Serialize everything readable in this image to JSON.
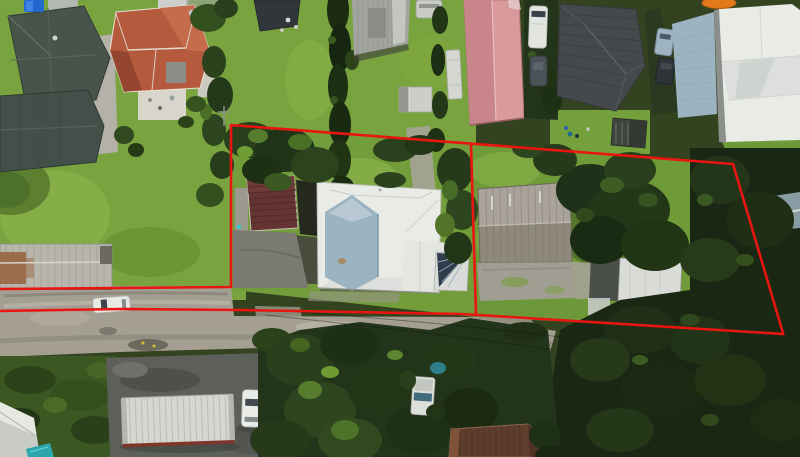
{
  "image": {
    "type": "aerial-drone-photograph",
    "description": "Overhead aerial photo of a suburban street; a red surveyed boundary overlay outlines a deep property (front lot with white-roofed house, rear lot with gray shed) plus two red road-frontage lines running to the left edge of the frame.",
    "width_px": 800,
    "height_px": 457
  },
  "boundary": {
    "color": "#e81510",
    "stroke_width": 2.6,
    "outer_path": "M0,289 L231,287 L231,125 L733,164 L783,333",
    "road_frontage_path": "M0,311 L120,309 L240,310 L462,314 L783,334",
    "divider_path": "M471,145 L476,315"
  },
  "palette": {
    "grass": "#79a33f",
    "grass_shaded": "#54762c",
    "road_gravel": "#a49f92",
    "asphalt": "#5d605a",
    "forest": "#1b2715",
    "tree_dark": "#22351a",
    "white_roof": "#e9eBE7",
    "blue_gray_roof": "#9cb3c1",
    "terracotta_roof": "#b65a3e",
    "dark_green_roof": "#48544b",
    "maroon_roof": "#633431",
    "pink_roof": "#d99a9c",
    "charcoal_roof": "#45494c",
    "shed_gray": "#a9a399",
    "truck_white": "#d4d6d0",
    "teal_pool": "#2ba6ab"
  },
  "scene": {
    "objects": [
      "dark-green-roof-houses-top-left",
      "terracotta-roof-house",
      "corrugated-garage-top-middle",
      "pink-roof-outbuilding",
      "charcoal-tile-roof-house",
      "white-modern-house-top-right",
      "central-house-white-and-blue-roof",
      "maroon-roof-garage",
      "rear-gray-shed",
      "small-white-shed",
      "gravel-road-with-white-car",
      "truck-trailer-parking",
      "dense-trees-right-and-bottom",
      "red-property-boundary-overlay"
    ]
  }
}
